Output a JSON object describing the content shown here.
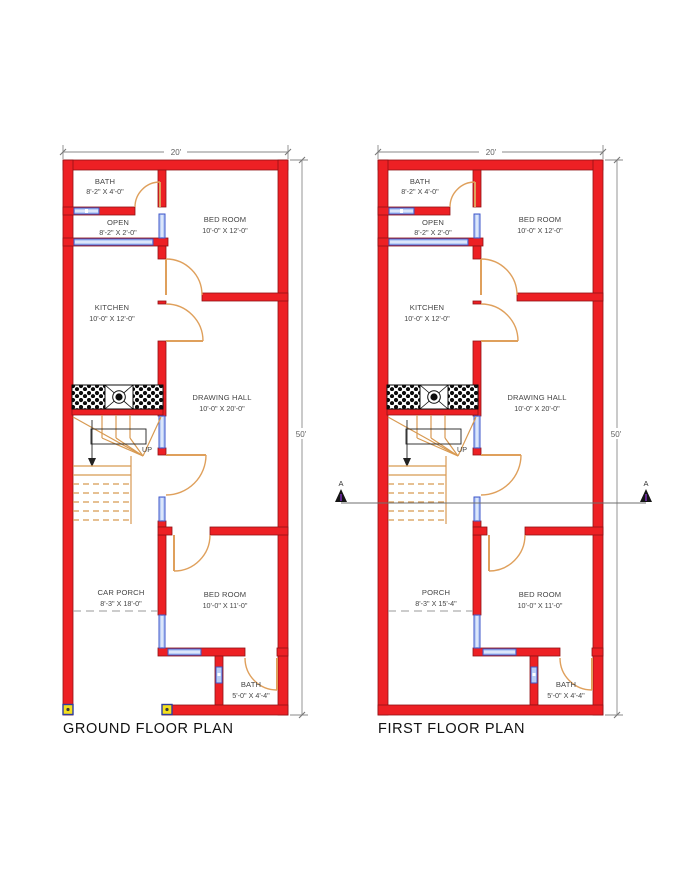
{
  "colors": {
    "wall": "#ed2024",
    "wallline": "#8f1115",
    "door": "#dfa05c",
    "stair": "#d89a52",
    "winfill": "#b9cdf6",
    "winline": "#3f57c9",
    "dim": "#8a8a8a",
    "dimtext": "#5f5f5f",
    "label": "#454545",
    "title": "#101010",
    "hatch": "#0c0c0c",
    "marker": "#f4e01d",
    "markerline": "#2f3e9f",
    "section": "#6f6f6f",
    "saccent": "#8b2fd0",
    "blk": "#222222"
  },
  "ground_floor": {
    "title": "GROUND FLOOR PLAN",
    "width_dim": "20'",
    "height_dim": "50'",
    "stair_label": "UP",
    "rooms": {
      "bath_top": {
        "name": "BATH",
        "size": "8'-2\" X 4'-0\""
      },
      "open": {
        "name": "OPEN",
        "size": "8'-2\" X 2'-0\""
      },
      "bedroom_top": {
        "name": "BED ROOM",
        "size": "10'-0\" X 12'-0\""
      },
      "kitchen": {
        "name": "KITCHEN",
        "size": "10'-0\" X 12'-0\""
      },
      "drawing_hall": {
        "name": "DRAWING HALL",
        "size": "10'-0\" X 20'-0\""
      },
      "car_porch": {
        "name": "CAR PORCH",
        "size": "8'-3\" X 18'-0\""
      },
      "bedroom_bottom": {
        "name": "BED ROOM",
        "size": "10'-0\" X 11'-0\""
      },
      "bath_bottom": {
        "name": "BATH",
        "size": "5'-0\" X 4'-4\""
      }
    }
  },
  "first_floor": {
    "title": "FIRST FLOOR PLAN",
    "width_dim": "20'",
    "height_dim": "50'",
    "stair_label": "UP",
    "section_label": "A",
    "rooms": {
      "bath_top": {
        "name": "BATH",
        "size": "8'-2\" X 4'-0\""
      },
      "open": {
        "name": "OPEN",
        "size": "8'-2\" X 2'-0\""
      },
      "bedroom_top": {
        "name": "BED ROOM",
        "size": "10'-0\" X 12'-0\""
      },
      "kitchen": {
        "name": "KITCHEN",
        "size": "10'-0\" X 12'-0\""
      },
      "drawing_hall": {
        "name": "DRAWING HALL",
        "size": "10'-0\" X 20'-0\""
      },
      "porch": {
        "name": "PORCH",
        "size": "8'-3\" X 15'-4\""
      },
      "bedroom_bottom": {
        "name": "BED ROOM",
        "size": "10'-0\" X 11'-0\""
      },
      "bath_bottom": {
        "name": "BATH",
        "size": "5'-0\" X 4'-4\""
      }
    }
  }
}
